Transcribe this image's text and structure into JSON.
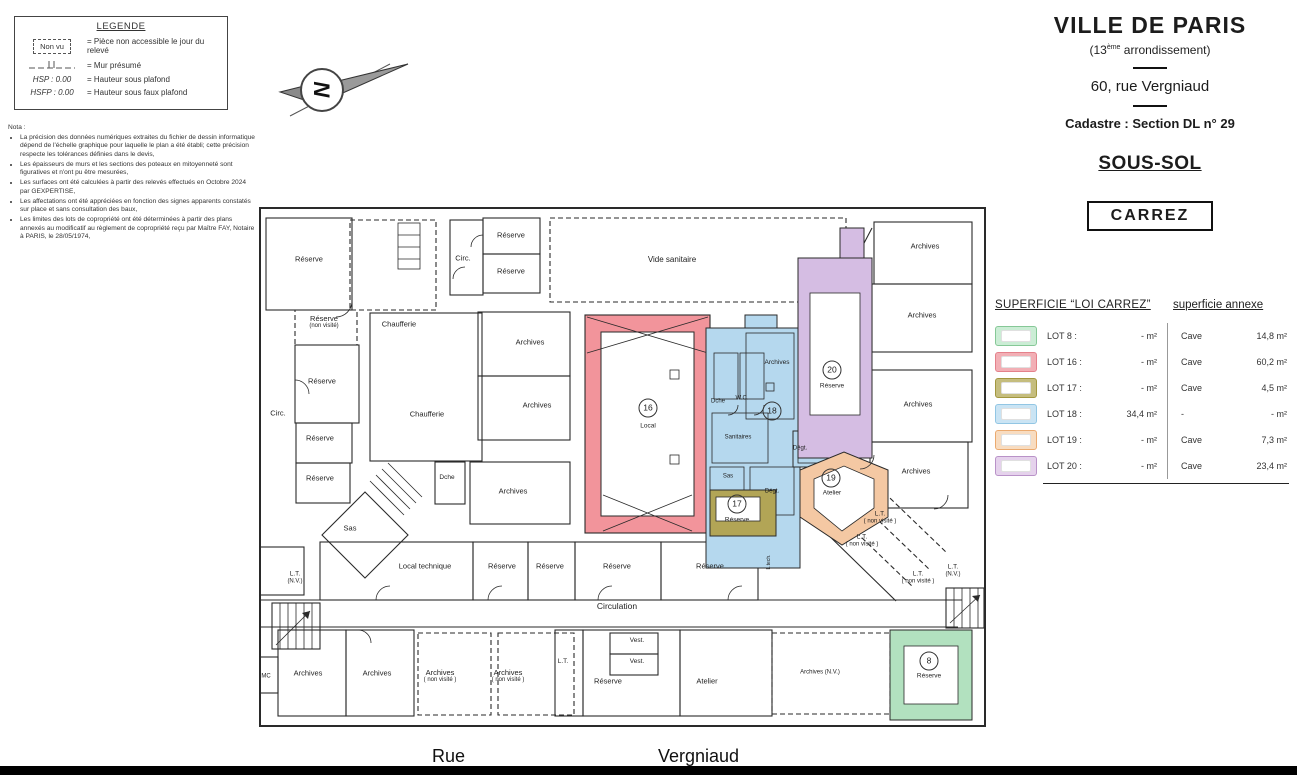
{
  "legend": {
    "title": "LEGENDE",
    "items": [
      {
        "sym_label": "Non vu",
        "text": "= Pièce non accessible le jour du relevé"
      },
      {
        "sym_label": "",
        "text": "= Mur présumé"
      },
      {
        "sym_label": "HSP : 0.00",
        "text": "= Hauteur sous plafond"
      },
      {
        "sym_label": "HSFP : 0.00",
        "text": "= Hauteur sous faux plafond"
      }
    ]
  },
  "nota": {
    "title": "Nota :",
    "items": [
      "La précision des données numériques extraites du fichier de dessin informatique dépend de l'échelle graphique pour laquelle le plan a été établi; cette précision respecte les tolérances définies dans le devis,",
      "Les épaisseurs de murs et les sections des poteaux en mitoyenneté sont figuratives et n'ont pu être mesurées,",
      "Les surfaces ont été calculées à partir des relevés effectués en Octobre 2024 par GEXPERTISE,",
      "Les affectations ont été appréciées en fonction des signes apparents constatés sur place et sans consultation des baux,",
      "Les limites des lots de copropriété ont été déterminées à partir des plans annexés au modificatif au règlement de copropriété reçu par Maître FAY, Notaire à PARIS, le 28/05/1974,"
    ]
  },
  "compass": {
    "letter": "N"
  },
  "header": {
    "city": "VILLE DE PARIS",
    "arr_prefix": "(13",
    "arr_sup": "ème",
    "arr_suffix": " arrondissement)",
    "address": "60, rue Vergniaud",
    "cadastre": "Cadastre : Section DL n° 29",
    "level": "SOUS-SOL",
    "carrez_box": "CARREZ"
  },
  "table": {
    "col1_header": "SUPERFICIE “LOI CARREZ”",
    "col2_header": "superficie annexe",
    "rows": [
      {
        "lot": "LOT 8 :",
        "carrez": "- m²",
        "annex_type": "Cave",
        "annex_value": "14,8 m²",
        "border": "#86c897",
        "fill": "#cbedd5"
      },
      {
        "lot": "LOT 16 :",
        "carrez": "- m²",
        "annex_type": "Cave",
        "annex_value": "60,2 m²",
        "border": "#e4818b",
        "fill": "#f2afb5"
      },
      {
        "lot": "LOT 17 :",
        "carrez": "- m²",
        "annex_type": "Cave",
        "annex_value": "4,5 m²",
        "border": "#a2973f",
        "fill": "#c5bd7e"
      },
      {
        "lot": "LOT 18 :",
        "carrez": "34,4 m²",
        "annex_type": "-",
        "annex_value": "- m²",
        "border": "#92c6e4",
        "fill": "#cae4f4"
      },
      {
        "lot": "LOT 19 :",
        "carrez": "- m²",
        "annex_type": "Cave",
        "annex_value": "7,3 m²",
        "border": "#ebaa6f",
        "fill": "#f8dcc0"
      },
      {
        "lot": "LOT 20 :",
        "carrez": "- m²",
        "annex_type": "Cave",
        "annex_value": "23,4 m²",
        "border": "#b992c8",
        "fill": "#e5d2ec"
      }
    ]
  },
  "plan": {
    "colors": {
      "lot8_green": "#b2e1bf",
      "lot16_red": "#f2949b",
      "lot17_olive": "#b2a556",
      "lot18_blue": "#b5d8ee",
      "lot19_orange": "#f4c8a3",
      "lot20_purple": "#d5bde3"
    },
    "rooms": [
      {
        "l": "Réserve",
        "x": 51,
        "y": 54
      },
      {
        "l": "Réserve",
        "s": "(non visité)",
        "x": 66,
        "y": 117
      },
      {
        "l": "Réserve",
        "x": 64,
        "y": 176
      },
      {
        "l": "Chaufferie",
        "x": 141,
        "y": 119
      },
      {
        "l": "Circ.",
        "x": 20,
        "y": 208
      },
      {
        "l": "Réserve",
        "x": 62,
        "y": 233
      },
      {
        "l": "Réserve",
        "x": 62,
        "y": 273
      },
      {
        "l": "Circ.",
        "x": 205,
        "y": 53
      },
      {
        "l": "Réserve",
        "x": 253,
        "y": 30
      },
      {
        "l": "Réserve",
        "x": 253,
        "y": 66
      },
      {
        "l": "Vide sanitaire",
        "x": 414,
        "y": 55,
        "fs": 8
      },
      {
        "l": "Archives",
        "x": 272,
        "y": 137
      },
      {
        "l": "Archives",
        "x": 279,
        "y": 200
      },
      {
        "l": "Chaufferie",
        "x": 169,
        "y": 209
      },
      {
        "l": "Dche",
        "x": 189,
        "y": 273,
        "fs": 6.5
      },
      {
        "l": "Archives",
        "x": 255,
        "y": 286
      },
      {
        "l": "Sas",
        "x": 92,
        "y": 323
      },
      {
        "l": "Local technique",
        "x": 167,
        "y": 361
      },
      {
        "l": "Réserve",
        "x": 244,
        "y": 361
      },
      {
        "l": "Réserve",
        "x": 292,
        "y": 361
      },
      {
        "l": "Réserve",
        "x": 359,
        "y": 361
      },
      {
        "l": "Réserve",
        "x": 452,
        "y": 361
      },
      {
        "l": "Circulation",
        "x": 359,
        "y": 401,
        "fs": 8.5
      },
      {
        "l": "L.T.",
        "s": "(N.V.)",
        "x": 37,
        "y": 373,
        "fs": 6.5
      },
      {
        "l": "MC",
        "x": 8,
        "y": 472,
        "fs": 6
      },
      {
        "l": "Archives",
        "x": 50,
        "y": 468
      },
      {
        "l": "Archives",
        "x": 119,
        "y": 468
      },
      {
        "l": "Archives",
        "s": "( non visité )",
        "x": 182,
        "y": 471
      },
      {
        "l": "Archives",
        "s": "( non visité )",
        "x": 250,
        "y": 471
      },
      {
        "l": "L.T.",
        "x": 305,
        "y": 457,
        "fs": 6.5
      },
      {
        "l": "Réserve",
        "x": 350,
        "y": 476
      },
      {
        "l": "Vest.",
        "x": 379,
        "y": 436,
        "fs": 6.5
      },
      {
        "l": "Vest.",
        "x": 379,
        "y": 457,
        "fs": 6.5
      },
      {
        "l": "Atelier",
        "x": 449,
        "y": 476
      },
      {
        "l": "Archives (N.V.)",
        "x": 562,
        "y": 468,
        "fs": 6
      },
      {
        "l": "Archives",
        "x": 667,
        "y": 41
      },
      {
        "l": "Archives",
        "x": 664,
        "y": 110
      },
      {
        "l": "Archives",
        "x": 660,
        "y": 199
      },
      {
        "l": "Archives",
        "x": 658,
        "y": 266
      },
      {
        "l": "L.T.",
        "s": "( non visité )",
        "x": 622,
        "y": 313,
        "fs": 6.5
      },
      {
        "l": "L.T.",
        "s": "( non visité )",
        "x": 604,
        "y": 336,
        "fs": 6.5
      },
      {
        "l": "L.T.",
        "s": "( non visité )",
        "x": 660,
        "y": 373,
        "fs": 6.5
      },
      {
        "l": "L.T.",
        "s": "(N.V.)",
        "x": 695,
        "y": 366,
        "fs": 6.5
      },
      {
        "l": "Dche",
        "x": 460,
        "y": 197,
        "fs": 6
      },
      {
        "l": "W.C.",
        "x": 484,
        "y": 194,
        "fs": 6
      },
      {
        "l": "Archives",
        "x": 519,
        "y": 158,
        "fs": 6.5
      },
      {
        "l": "Sanitaires",
        "x": 480,
        "y": 233,
        "fs": 6
      },
      {
        "l": "Sas",
        "x": 470,
        "y": 272,
        "fs": 6
      },
      {
        "l": "Dégt.",
        "x": 542,
        "y": 244,
        "fs": 6
      },
      {
        "l": "Dégt.",
        "x": 514,
        "y": 287,
        "fs": 6
      },
      {
        "l": "L.tech.",
        "x": 511,
        "y": 357,
        "fs": 5,
        "rot": -90
      }
    ],
    "lots": [
      {
        "num": "16",
        "name": "Local",
        "nx": 390,
        "ny": 203,
        "tx": 390,
        "ty": 221
      },
      {
        "num": "17",
        "name": "Réserve",
        "nx": 479,
        "ny": 299,
        "tx": 479,
        "ty": 315
      },
      {
        "num": "18",
        "name": "",
        "nx": 514,
        "ny": 206,
        "tx": 0,
        "ty": 0
      },
      {
        "num": "19",
        "name": "Atelier",
        "nx": 573,
        "ny": 273,
        "tx": 574,
        "ty": 288
      },
      {
        "num": "20",
        "name": "Réserve",
        "nx": 574,
        "ny": 165,
        "tx": 574,
        "ty": 181
      },
      {
        "num": "8",
        "name": "Réserve",
        "nx": 671,
        "ny": 456,
        "tx": 671,
        "ty": 471
      }
    ]
  },
  "street": {
    "word1": "Rue",
    "word2": "Vergniaud"
  }
}
